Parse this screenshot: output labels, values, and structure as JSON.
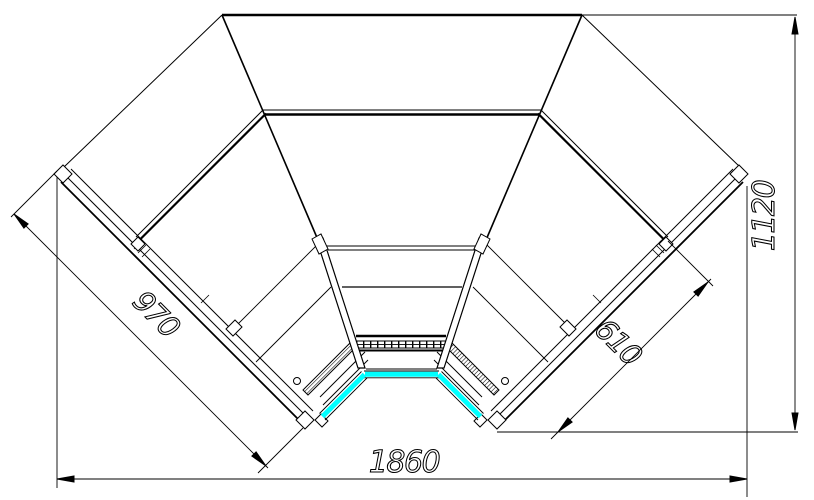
{
  "drawing": {
    "colors": {
      "line": "#000000",
      "highlight": "#00ffff",
      "background": "#ffffff"
    },
    "dimensions": {
      "left_wing_length": "970",
      "right_wing_depth": "610",
      "overall_width": "1860",
      "overall_height": "1120"
    }
  }
}
